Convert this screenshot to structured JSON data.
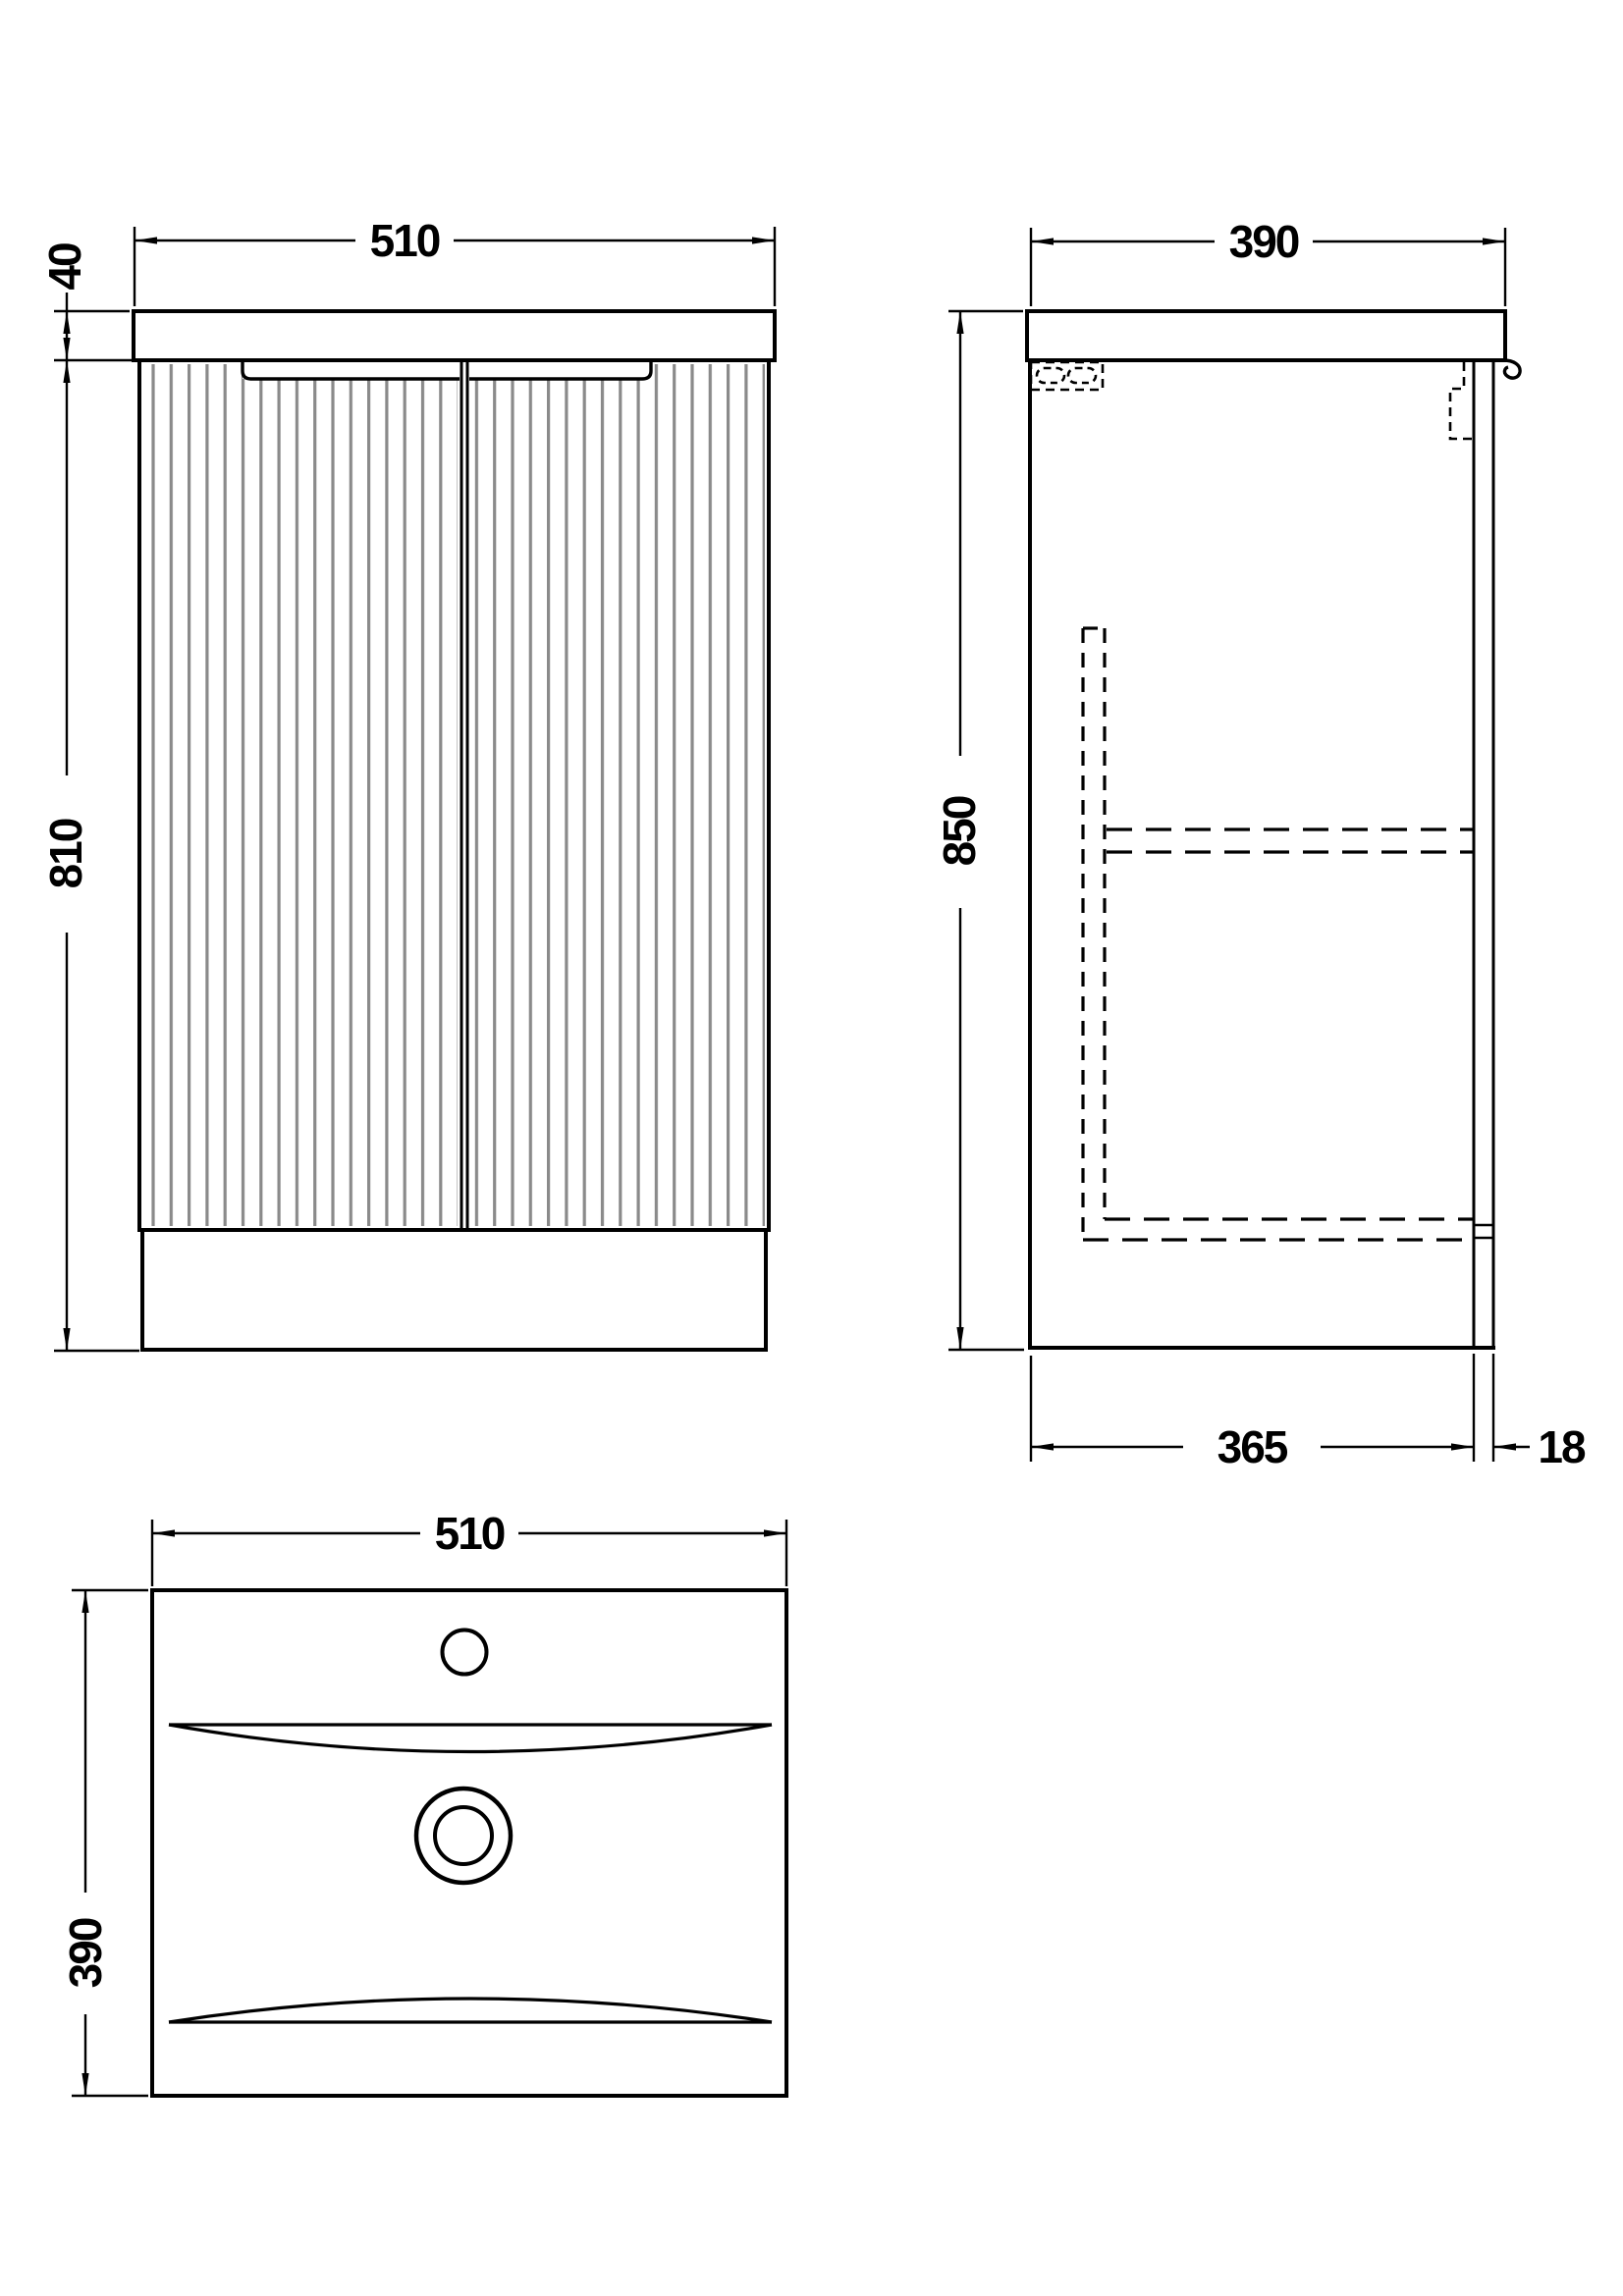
{
  "drawing": {
    "front_view": {
      "width_label": "510",
      "countertop_height_label": "40",
      "cabinet_height_label": "810"
    },
    "side_view": {
      "depth_label": "390",
      "height_label": "850",
      "internal_depth_label": "365",
      "back_panel_label": "18"
    },
    "plan_view": {
      "width_label": "510",
      "depth_label": "390"
    }
  },
  "colors": {
    "line": "#000000",
    "flute": "#8a8a8a",
    "background": "#ffffff"
  }
}
